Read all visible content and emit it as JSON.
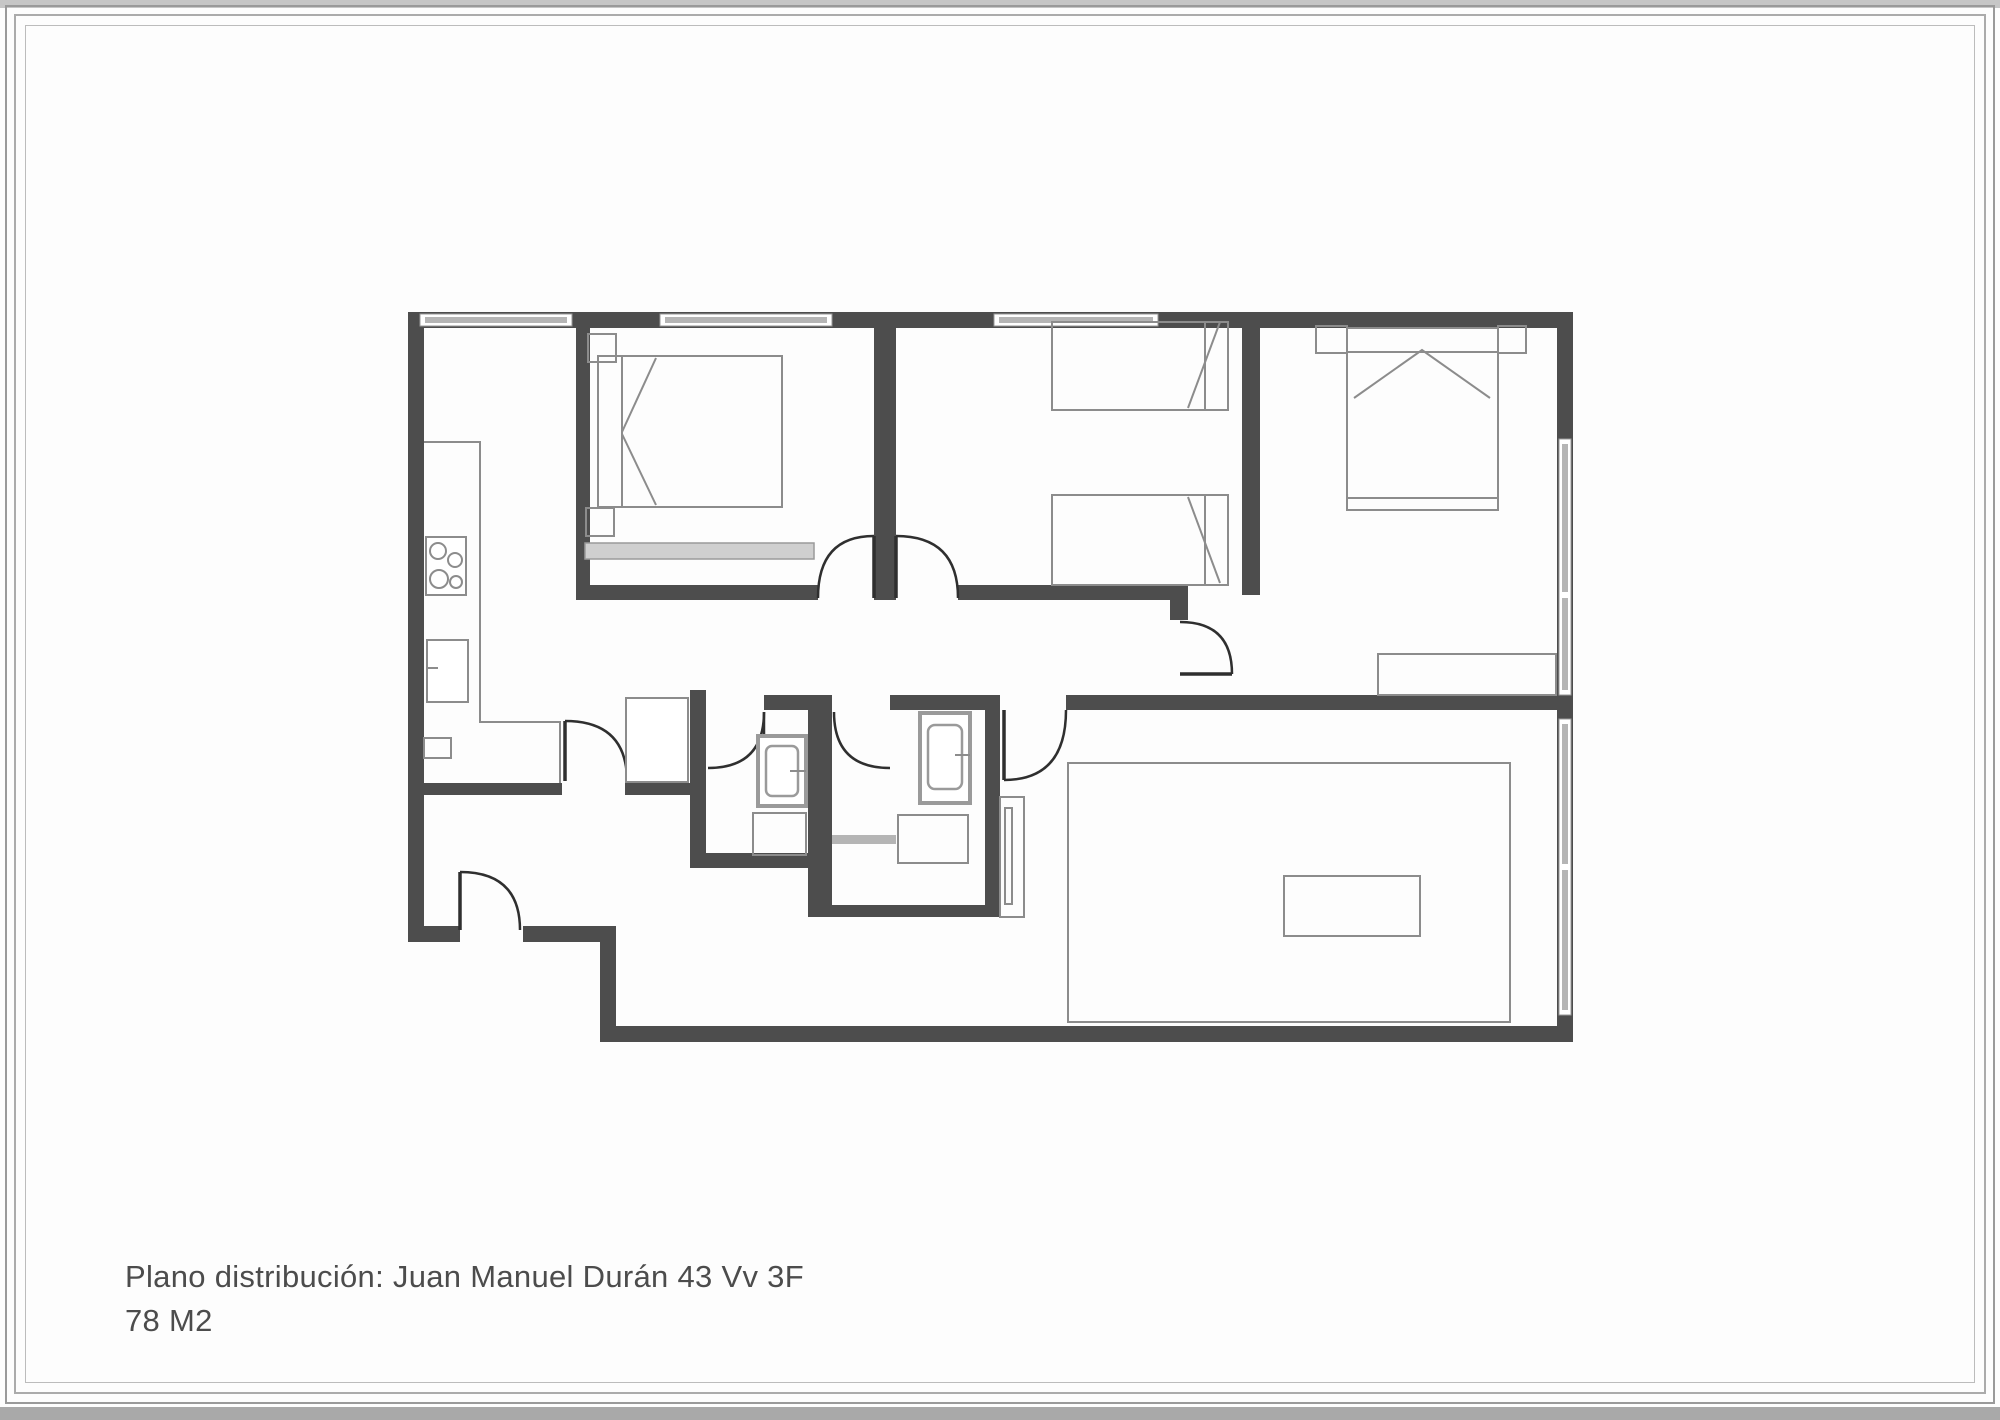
{
  "caption": {
    "line1": "Plano distribución: Juan Manuel Durán 43 Vv 3F",
    "line2": "78 M2"
  },
  "colors": {
    "wall": "#4d4d4d",
    "window_pane": "#b5b5b5",
    "furniture_line": "#8c8c8c",
    "door_line": "#2f2f2f",
    "caption_text": "#4c4c4c",
    "frame_gray": "#9a9a9a"
  },
  "plan": {
    "type": "apartment-floor-plan",
    "area_label": "78 M2",
    "rooms": [
      "kitchen",
      "bedroom-1",
      "bedroom-2",
      "bedroom-3",
      "bathroom-1",
      "bathroom-2",
      "hall",
      "corridor",
      "living-room"
    ],
    "windows": [
      "kitchen-window-top",
      "bedroom1-window-top",
      "bedroom2-window-top",
      "bedroom3-window-east",
      "living-window-east"
    ],
    "doors": [
      "entry-door",
      "kitchen-door",
      "bedroom1-door",
      "bedroom2-door",
      "bedroom3-door",
      "bathroom1-door",
      "bathroom2-door",
      "living-door"
    ],
    "fixtures": [
      "stove",
      "kitchen-sink",
      "fridge",
      "double-bed-1",
      "single-bed-a",
      "single-bed-b",
      "double-bed-3",
      "toilet-1",
      "basin-1",
      "toilet-2",
      "basin-2",
      "desk",
      "rug",
      "coffee-table"
    ]
  }
}
